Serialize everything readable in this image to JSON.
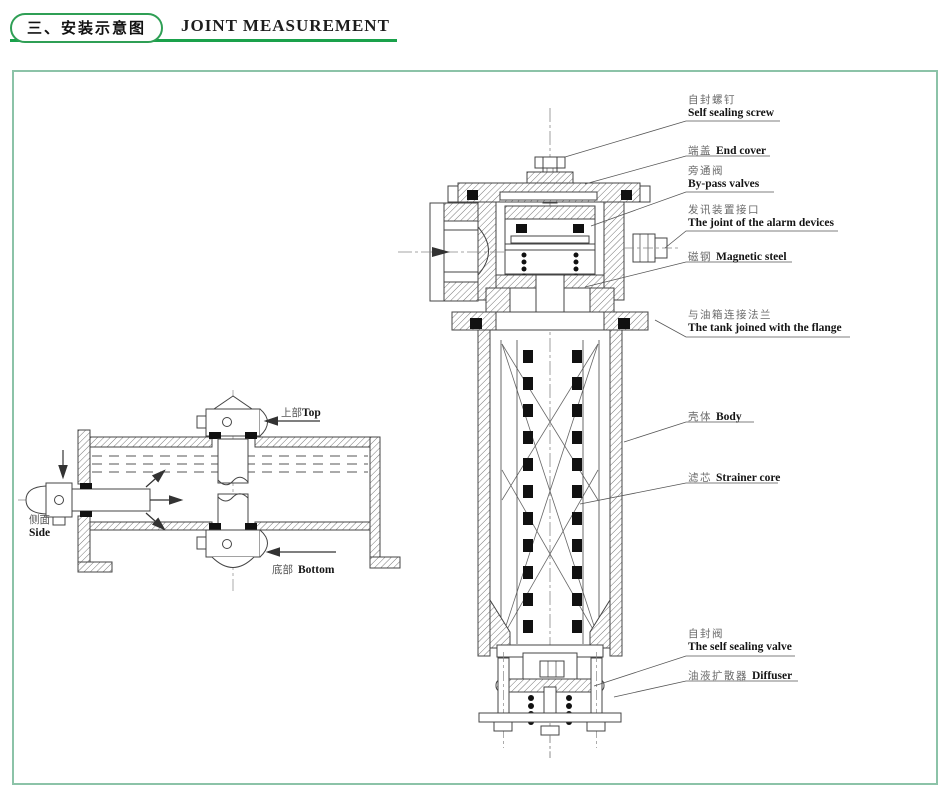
{
  "header": {
    "section_title_zh": "三、安装示意图",
    "title_en": "JOINT MEASUREMENT"
  },
  "diagram": {
    "part_labels": [
      {
        "zh": "自封螺钉",
        "en": "Self sealing screw"
      },
      {
        "zh": "端盖",
        "en": "End cover"
      },
      {
        "zh": "旁通阀",
        "en": "By-pass valves"
      },
      {
        "zh": "发讯装置接口",
        "en": "The joint of the alarm devices"
      },
      {
        "zh": "磁钢",
        "en": "Magnetic steel"
      },
      {
        "zh": "与油箱连接法兰",
        "en": "The tank joined with the flange"
      },
      {
        "zh": "壳体",
        "en": "Body"
      },
      {
        "zh": "滤芯",
        "en": "Strainer core"
      },
      {
        "zh": "自封阀",
        "en": "The self sealing valve"
      },
      {
        "zh": "油液扩散器",
        "en": "Diffuser"
      }
    ],
    "orientation_labels": [
      {
        "zh": "上部",
        "en": "Top"
      },
      {
        "zh": "侧面",
        "en": "Side"
      },
      {
        "zh": "底部",
        "en": "Bottom"
      }
    ]
  },
  "colors": {
    "accent_green": "#1aa14b",
    "pill_border_green": "#2f9f55",
    "frame_border_green": "#8cc3a8",
    "drawing_line": "#444444",
    "text_dark": "#141414",
    "text_gray": "#6a6a6a"
  }
}
